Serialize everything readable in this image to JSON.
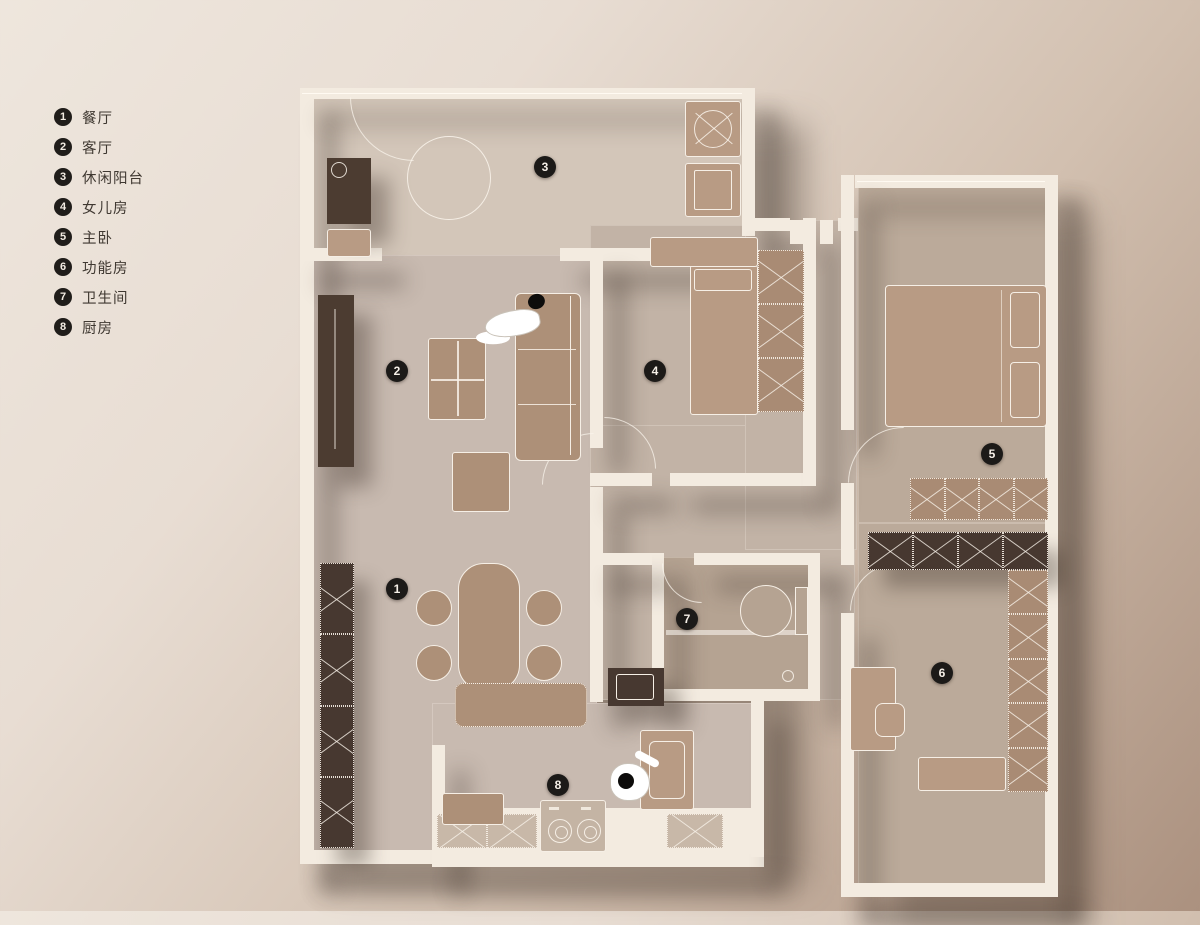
{
  "legend": {
    "items": [
      {
        "num": "1",
        "label": "餐厅"
      },
      {
        "num": "2",
        "label": "客厅"
      },
      {
        "num": "3",
        "label": "休闲阳台"
      },
      {
        "num": "4",
        "label": "女儿房"
      },
      {
        "num": "5",
        "label": "主卧"
      },
      {
        "num": "6",
        "label": "功能房"
      },
      {
        "num": "7",
        "label": "卫生间"
      },
      {
        "num": "8",
        "label": "厨房"
      }
    ]
  },
  "markers": [
    {
      "num": "1",
      "room": "dining"
    },
    {
      "num": "2",
      "room": "living"
    },
    {
      "num": "3",
      "room": "balcony"
    },
    {
      "num": "4",
      "room": "daughter-bedroom"
    },
    {
      "num": "5",
      "room": "master-bedroom"
    },
    {
      "num": "6",
      "room": "function-room"
    },
    {
      "num": "7",
      "room": "bathroom"
    },
    {
      "num": "8",
      "room": "kitchen"
    }
  ],
  "colors": {
    "background_top_left": "#ece3da",
    "background_bottom_right": "#a98f7d",
    "wall": "#f3ebe0",
    "floor_light": "#d3c6b9",
    "floor_dark": "#b5a392",
    "furniture_brown": "#ad9078",
    "cabinet_dark": "#4c3c31",
    "outline": "#f6efe6",
    "marker_bg": "#1c1a18",
    "marker_text": "#f5efe7",
    "legend_text": "#3f3831"
  }
}
